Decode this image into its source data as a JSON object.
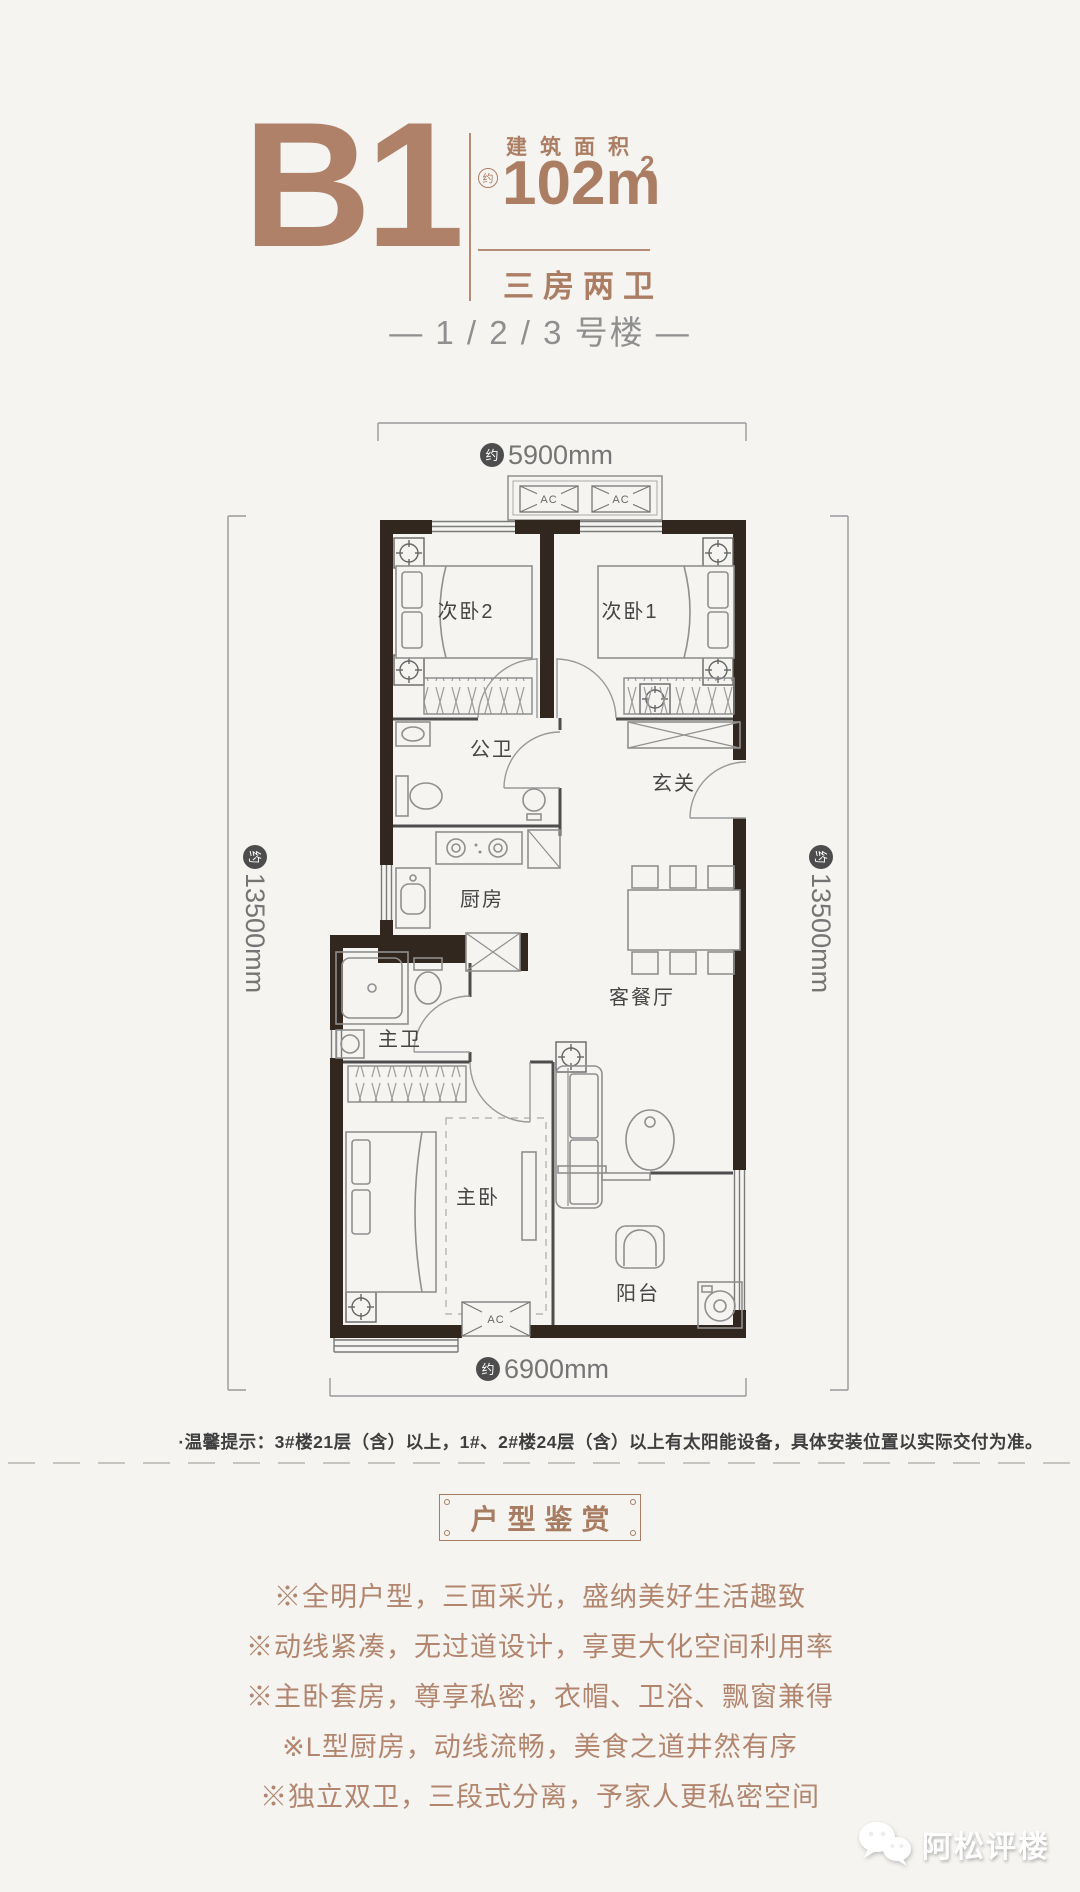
{
  "header": {
    "unit": "B1",
    "area_title": "建筑面积",
    "approx": "约",
    "area_value": "102m",
    "area_sup": "2",
    "rooms_type": "三房两卫",
    "building": "— 1 / 2 / 3 号楼 —"
  },
  "floorplan": {
    "approx": "约",
    "dim_top": "5900mm",
    "dim_left": "13500mm",
    "dim_right": "13500mm",
    "dim_bottom": "6900mm",
    "ac": "AC",
    "rooms": {
      "bedroom2": "次卧2",
      "bedroom1": "次卧1",
      "public_bath": "公卫",
      "entry": "玄关",
      "kitchen": "厨房",
      "living_dining": "客餐厅",
      "master_bath": "主卫",
      "master_bedroom": "主卧",
      "balcony": "阳台"
    }
  },
  "note": "·温馨提示：3#楼21层（含）以上，1#、2#楼24层（含）以上有太阳能设备，具体安装位置以实际交付为准。",
  "appreciation": {
    "title": "户型鉴赏",
    "bullets": [
      "※全明户型，三面采光，盛纳美好生活趣致",
      "※动线紧凑，无过道设计，享更大化空间利用率",
      "※主卧套房，尊享私密，衣帽、卫浴、飘窗兼得",
      "※L型厨房，动线流畅，美食之道井然有序",
      "※独立双卫，三段式分离，予家人更私密空间"
    ]
  },
  "watermark": "阿松评楼",
  "colors": {
    "accent": "#ab7e64",
    "wall": "#32271f",
    "dim_line": "#9a9a9a"
  }
}
